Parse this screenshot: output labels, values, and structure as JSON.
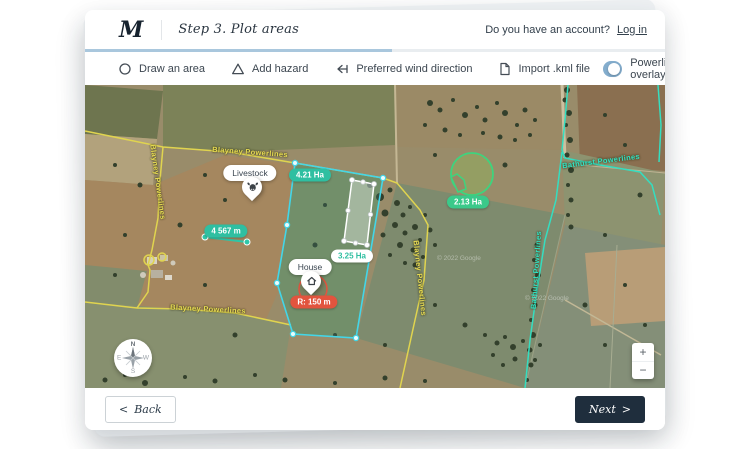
{
  "header": {
    "logo": "M",
    "title": "Step 3. Plot areas",
    "account_prompt": "Do you have an account?",
    "login_label": "Log in"
  },
  "progress": {
    "percent": 53
  },
  "toolbar": {
    "draw_area": "Draw an area",
    "add_hazard": "Add hazard",
    "wind": "Preferred wind direction",
    "import_kml": "Import .kml file",
    "toggle_label": "Powerline overlays",
    "toggle_on": true
  },
  "map": {
    "powerline_labels": {
      "blayney_top": "Blayney Powerlines",
      "blayney_left": "Blayney Powerlines",
      "blayney_bottom": "Blayney Powerlines",
      "blayney_right": "Blayney Powerlines",
      "bathurst_mid": "Bathurst Powerlines",
      "bathurst_lower": "Bathurst Powerlines"
    },
    "markers": {
      "livestock": "Livestock",
      "house": "House"
    },
    "badges": {
      "cyan_area": "4.21 Ha",
      "rect_area": "3.25 Ha",
      "circle_area": "2.13 Ha",
      "radius": "R: 150 m",
      "measurement": "4 567 m"
    },
    "watermark": "© 2022 Google",
    "compass": {
      "n": "N",
      "e": "E",
      "w": "W",
      "s": "S"
    },
    "zoom_in": "+",
    "zoom_out": "−"
  },
  "footer": {
    "back_chevron": "<",
    "back_label": "Back",
    "next_label": "Next",
    "next_chevron": ">"
  },
  "colors": {
    "teal": "#2fbfa1",
    "cyan": "#43d6e8",
    "green": "#3ed47e",
    "red": "#e2543e",
    "yellow": "#e0d44f",
    "navy": "#1f2e3d",
    "toggle_blue": "#84adcd",
    "progress_blue": "#a9c7dd"
  }
}
